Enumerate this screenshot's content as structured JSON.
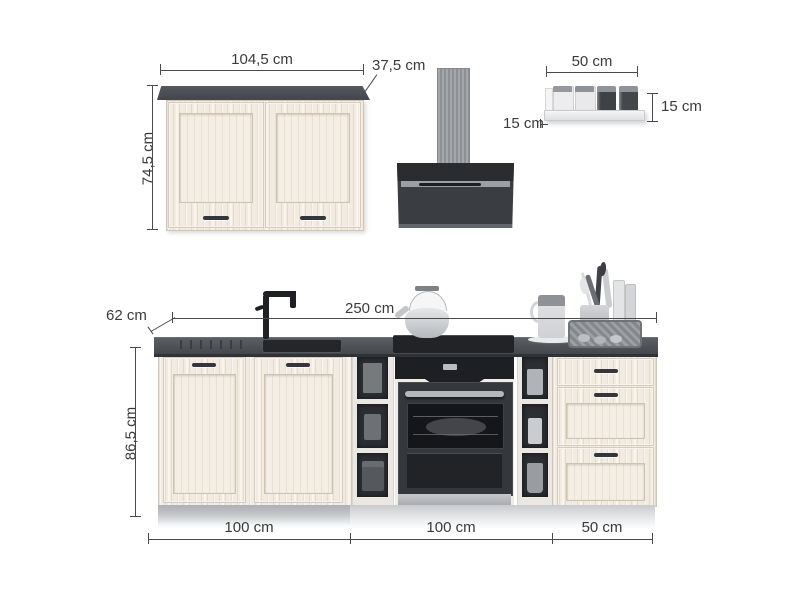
{
  "dims": {
    "wall_cabinet": {
      "width": "104,5 cm",
      "depth": "37,5 cm",
      "height": "74,5 cm"
    },
    "wall_shelf": {
      "width": "50 cm",
      "height": "15 cm",
      "depth": "15 cm"
    },
    "base_run": {
      "depth": "62 cm",
      "width": "250 cm",
      "height": "86,5 cm",
      "segments": [
        "100 cm",
        "100 cm",
        "50 cm"
      ]
    }
  },
  "colors": {
    "cabinet_wood": "#f2ebe1",
    "countertop": "#4a4d52",
    "appliance_black": "#26282c",
    "annotation": "#3b3b3b"
  }
}
